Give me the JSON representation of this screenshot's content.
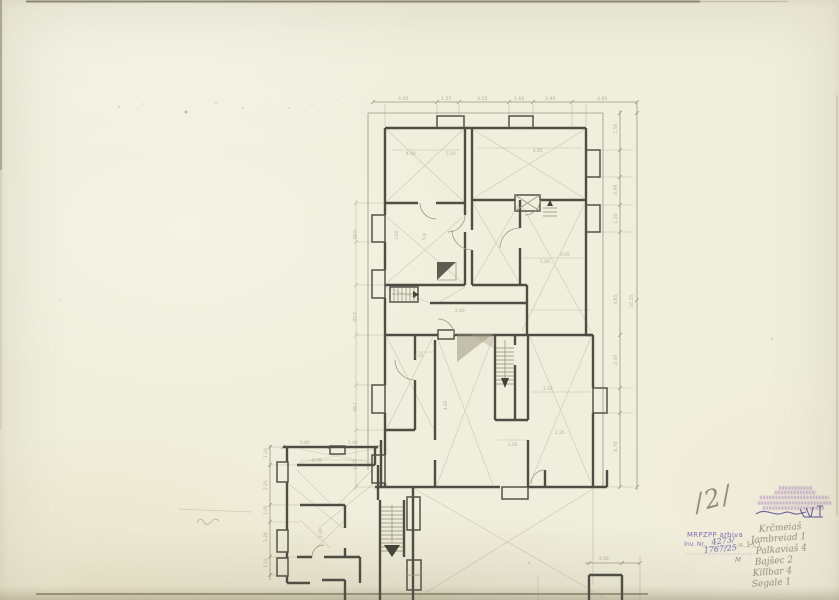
{
  "document": {
    "kind": "scanned hand-drawn architectural floor plan, pencil on aged paper",
    "paper_color": "#f0eedc",
    "pencil_color": "#9d9883",
    "wall_color": "#504d44"
  },
  "page_marks": {
    "folio_number": "/2/",
    "pencil_squiggle_note": "small u-shaped pencil scribble, bottom-left"
  },
  "stamps": {
    "institution": {
      "ink_color": "#9466b1",
      "legibility": "illegible small purple print, 5 lines, overwritten by dark ink signature strokes"
    },
    "archive": {
      "ink_color": "#6f5bab",
      "line1": "MRPZPP arhiva",
      "line2": "Inv. Nr.",
      "inv_no_hand_top": "4273∕",
      "inv_no_hand_bottom": "1767/25",
      "pencil_note": "= 1 (·)",
      "pencil_note2": "M"
    }
  },
  "handwritten_list": {
    "note": "faint pencil cursive, best-effort transcription",
    "items": [
      "Krčmeiaš",
      "Jambreiad 1",
      "Palkaviaš 4",
      "Bajšec 2",
      "Killbar 4",
      "Segale 1"
    ]
  },
  "dims": {
    "top": [
      "4.40",
      "1.55",
      "3.55",
      "1.60",
      "2.90",
      "4.85"
    ],
    "right": [
      "1.50",
      "2.90",
      "1.20",
      "3.85",
      "2.35",
      "4.70"
    ],
    "right_overall": "16.25",
    "left": [
      "0.95",
      "2.10",
      "1.90",
      "2.35"
    ],
    "ext_left": [
      "1.10",
      "2.25",
      "1.05",
      "2.20",
      "1.15"
    ],
    "ext_top": [
      "2.80",
      "1.40"
    ],
    "bottom_right": "2.00",
    "interior": [
      "4.40",
      "5.10",
      "4.85",
      "3.05",
      "5.8",
      "2.60",
      "1.20",
      "0.95",
      "2.05",
      "4.62",
      "3.10",
      "2.35",
      "5.70",
      "2.20",
      "1.05"
    ]
  }
}
